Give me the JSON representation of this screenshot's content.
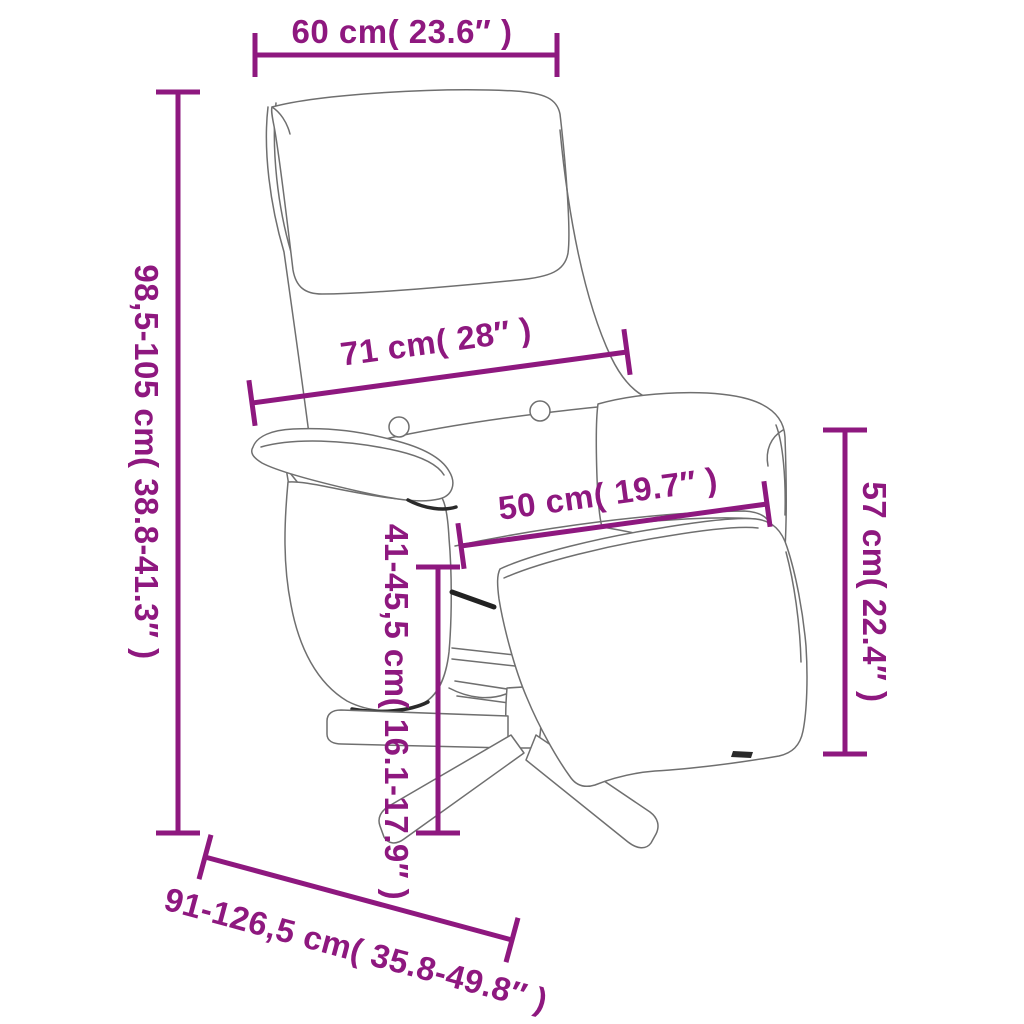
{
  "diagram": {
    "subject": "recliner-chair-with-footrest-line-art",
    "accent_color": "#8E187F",
    "line_art_color": "#6f6f6f",
    "background_color": "#ffffff",
    "dimensions": {
      "headrest_width": {
        "label": "60 cm( 23.6″ )",
        "cm": "60",
        "inch": "23.6"
      },
      "total_height": {
        "label": "98,5-105 cm( 38.8-41.3″ )",
        "cm": "98,5-105",
        "inch": "38.8-41.3"
      },
      "back_width": {
        "label": "71 cm( 28″ )",
        "cm": "71",
        "inch": "28"
      },
      "seat_width": {
        "label": "50 cm( 19.7″ )",
        "cm": "50",
        "inch": "19.7"
      },
      "arm_height": {
        "label": "57 cm( 22.4″ )",
        "cm": "57",
        "inch": "22.4"
      },
      "seat_height": {
        "label": "41-45,5 cm( 16.1-17.9″ )",
        "cm": "41-45,5",
        "inch": "16.1-17.9"
      },
      "depth": {
        "label": "91-126,5 cm( 35.8-49.8″ )",
        "cm": "91-126,5",
        "inch": "35.8-49.8"
      }
    }
  }
}
